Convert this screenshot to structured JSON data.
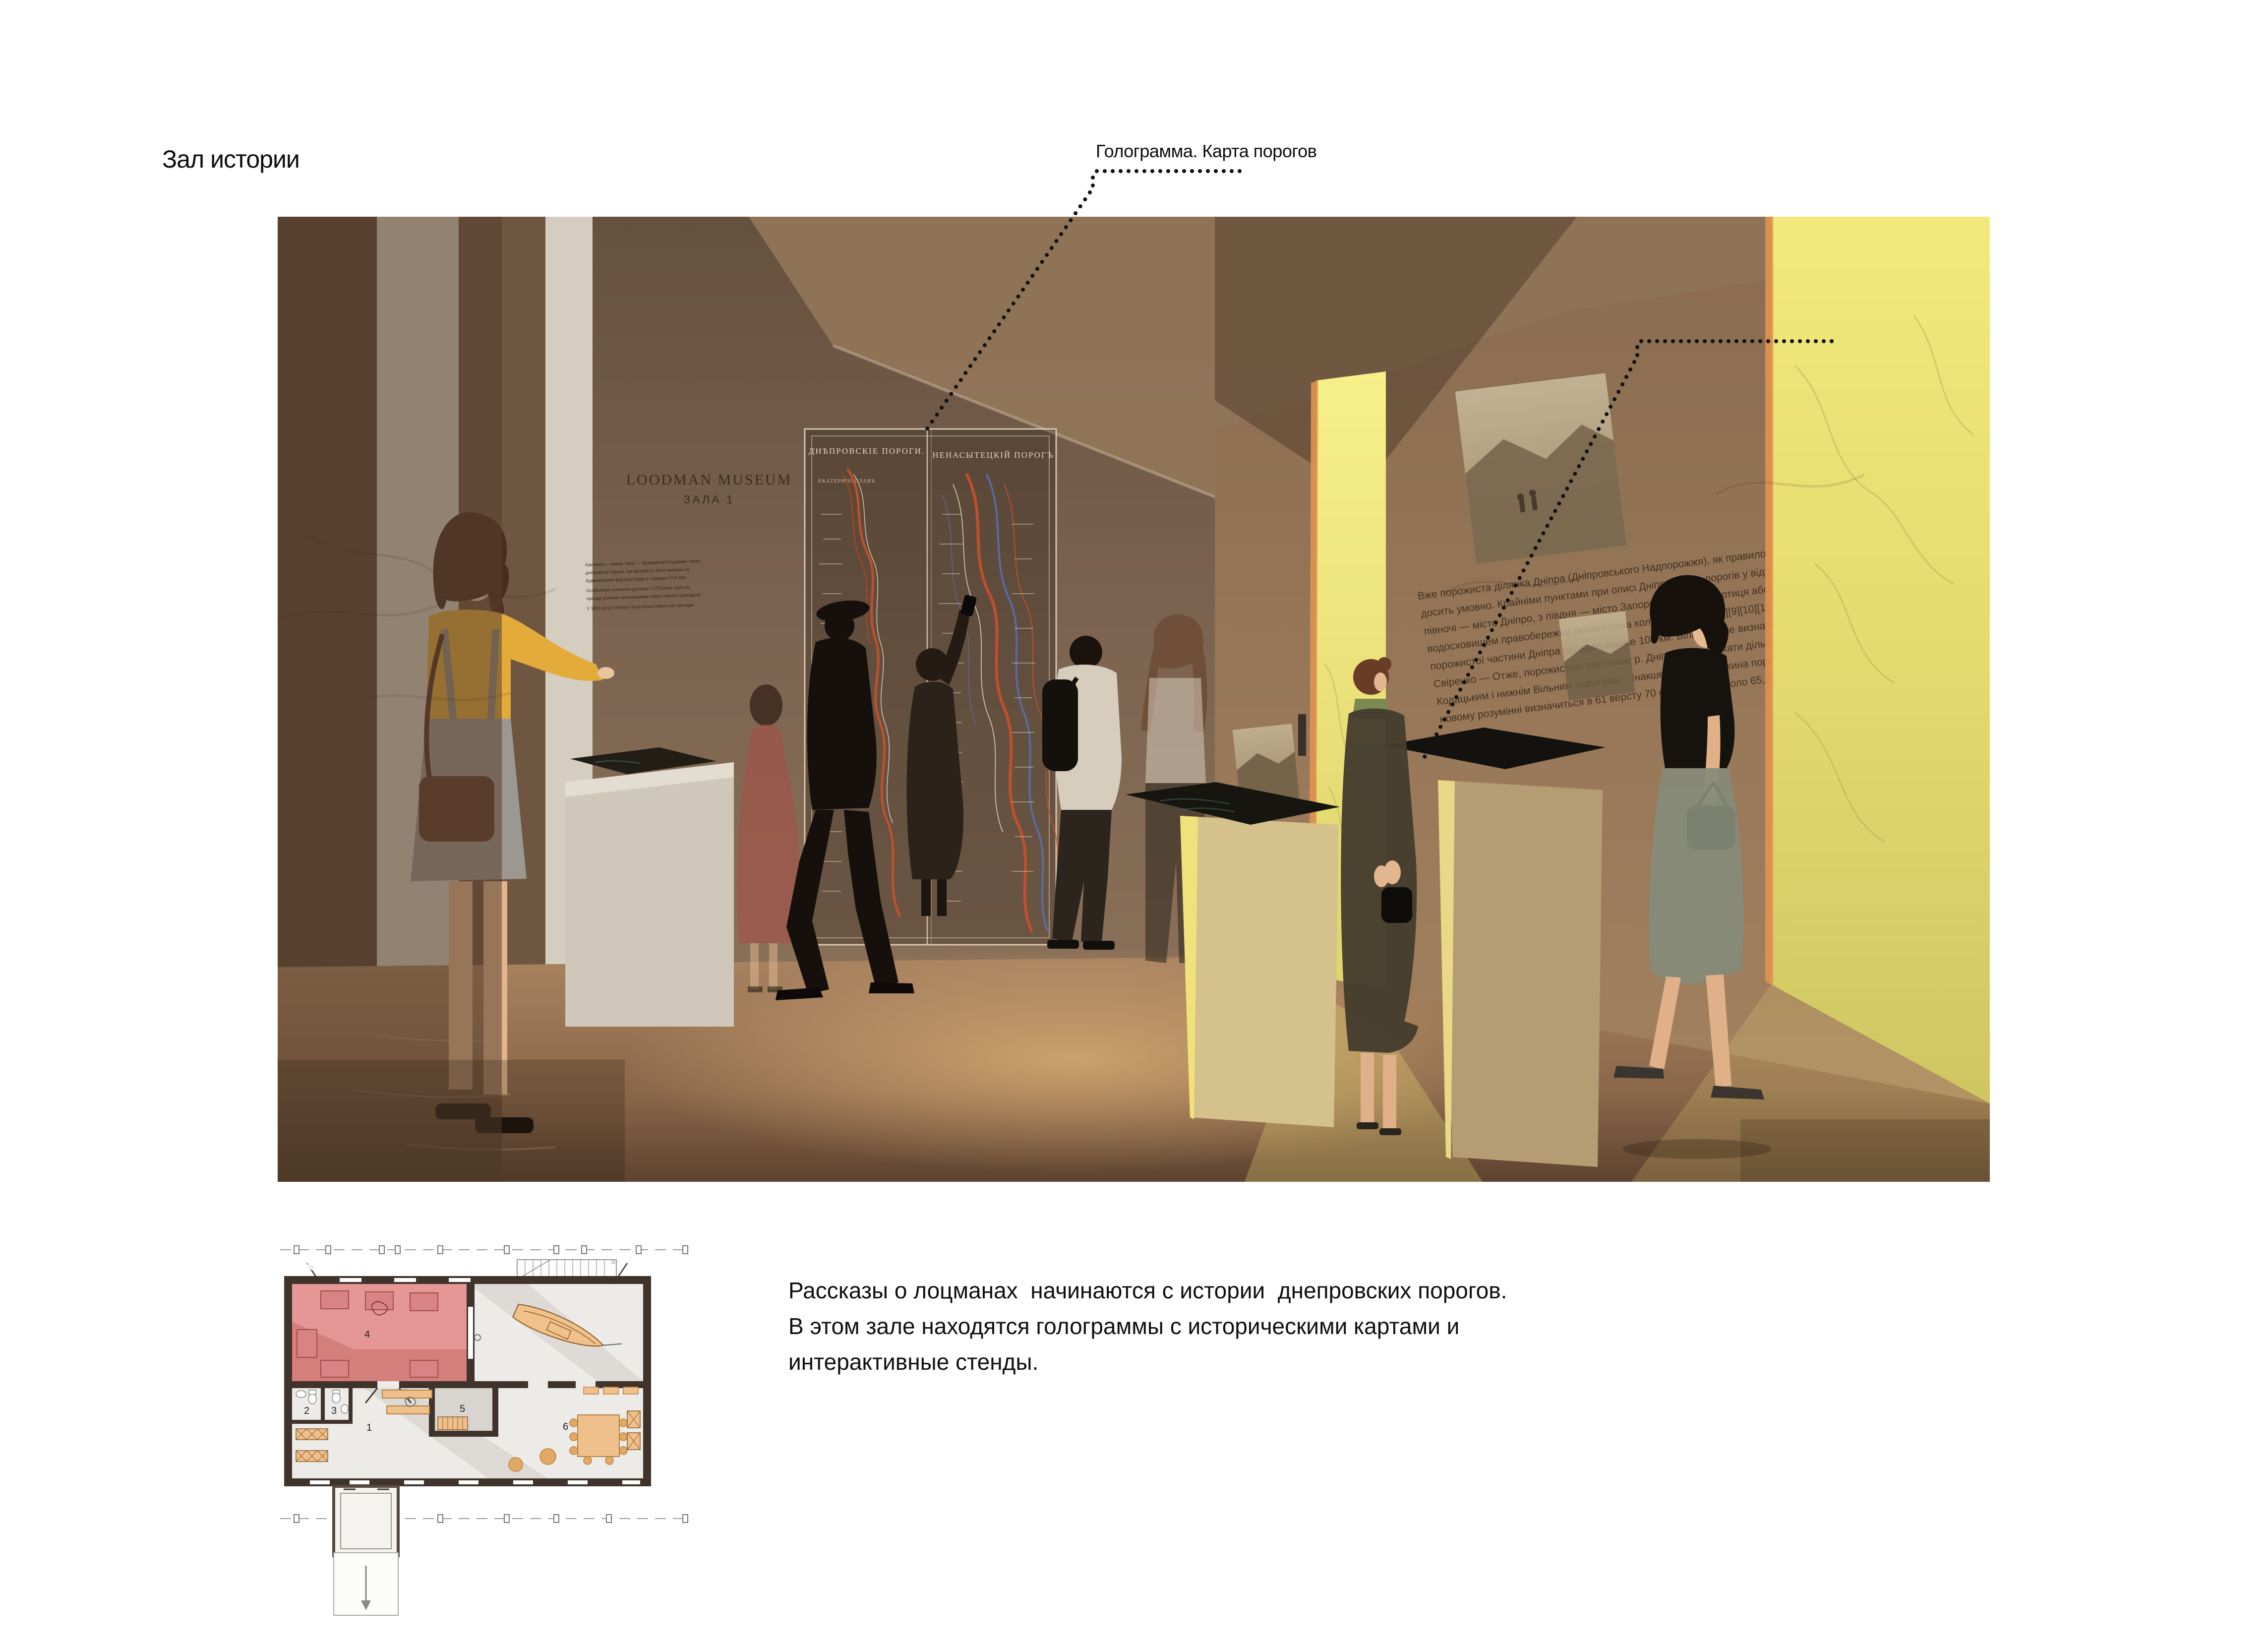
{
  "title": "Зал истории",
  "callouts": {
    "hologram_label": "Голограмма. Карта порогов",
    "screens_label": "Интерактивные экраны"
  },
  "description": {
    "lines": [
      "Рассказы о лоцманах  начинаются с истории  днепровских порогов.",
      "В этом зале находятся голограммы с историческими картами и",
      "интерактивные стенды."
    ]
  },
  "render": {
    "wall_sign": {
      "line1": "LOODMAN MUSEUM",
      "line2": "ЗАЛА 1"
    },
    "hologram_map": {
      "left_title": "ДНѢПРОВСКІЕ ПОРОГИ.",
      "right_title": "НЕНАСЫТЕЦКІЙ ПОРОГЪ",
      "left_subtitle": "ЕКАТЕРИНОСЛАВЪ"
    },
    "wall_article_lines": [
      "Вже порожиста ділянка Дніпра (Дніпровського Надпорожжя), як правило, окреслюються",
      "досить умовно. Крайніми пунктами при описі Дніпровських порогів у відповідних працях є: з",
      "півночі — місто Дніпро, з півдня — місто Запоріжжя, острів Хортиця або нині затоплена",
      "водосховищем правобережна менонітська колонія Кічкас [7][8][9][10][11]. Тобто, довжина",
      "порожистої частини Дніпра складає майже 100 км. Більш точне визначення подає проф. Д. О.",
      "Свіренко — Отже, порожистою частиною р. Дніпра слід вважати дільницю між верхнім",
      "Кодацьким і нижнім Вільним порогами... Інакше кажучи, довжина порожистої частини в",
      "новому розумінні визначиться в 61 версту 70 сажнів, тобто коло 65,2 км»[1]."
    ],
    "left_wall_text_lines": [
      "Кам'янка — нижня течія — проводилася суднами через",
      "дніпровські пороги. Ця місцевість була названа за",
      "будівництвом фортеці Кодак у середині XVII віку.",
      "Особливого значення дістала з 1750 року, коли по",
      "приїзду різними організаціями через пороги проводили",
      "У 1811 році в області були влаштовані нові заклади."
    ],
    "colors": {
      "wall_brown": "#7c6450",
      "window_yellow": "#eee473",
      "accent_red": "#d0706d",
      "furniture_orange": "#efc08c"
    }
  },
  "floor_plan": {
    "room_labels": [
      "1",
      "2",
      "3",
      "4",
      "5",
      "6"
    ]
  }
}
